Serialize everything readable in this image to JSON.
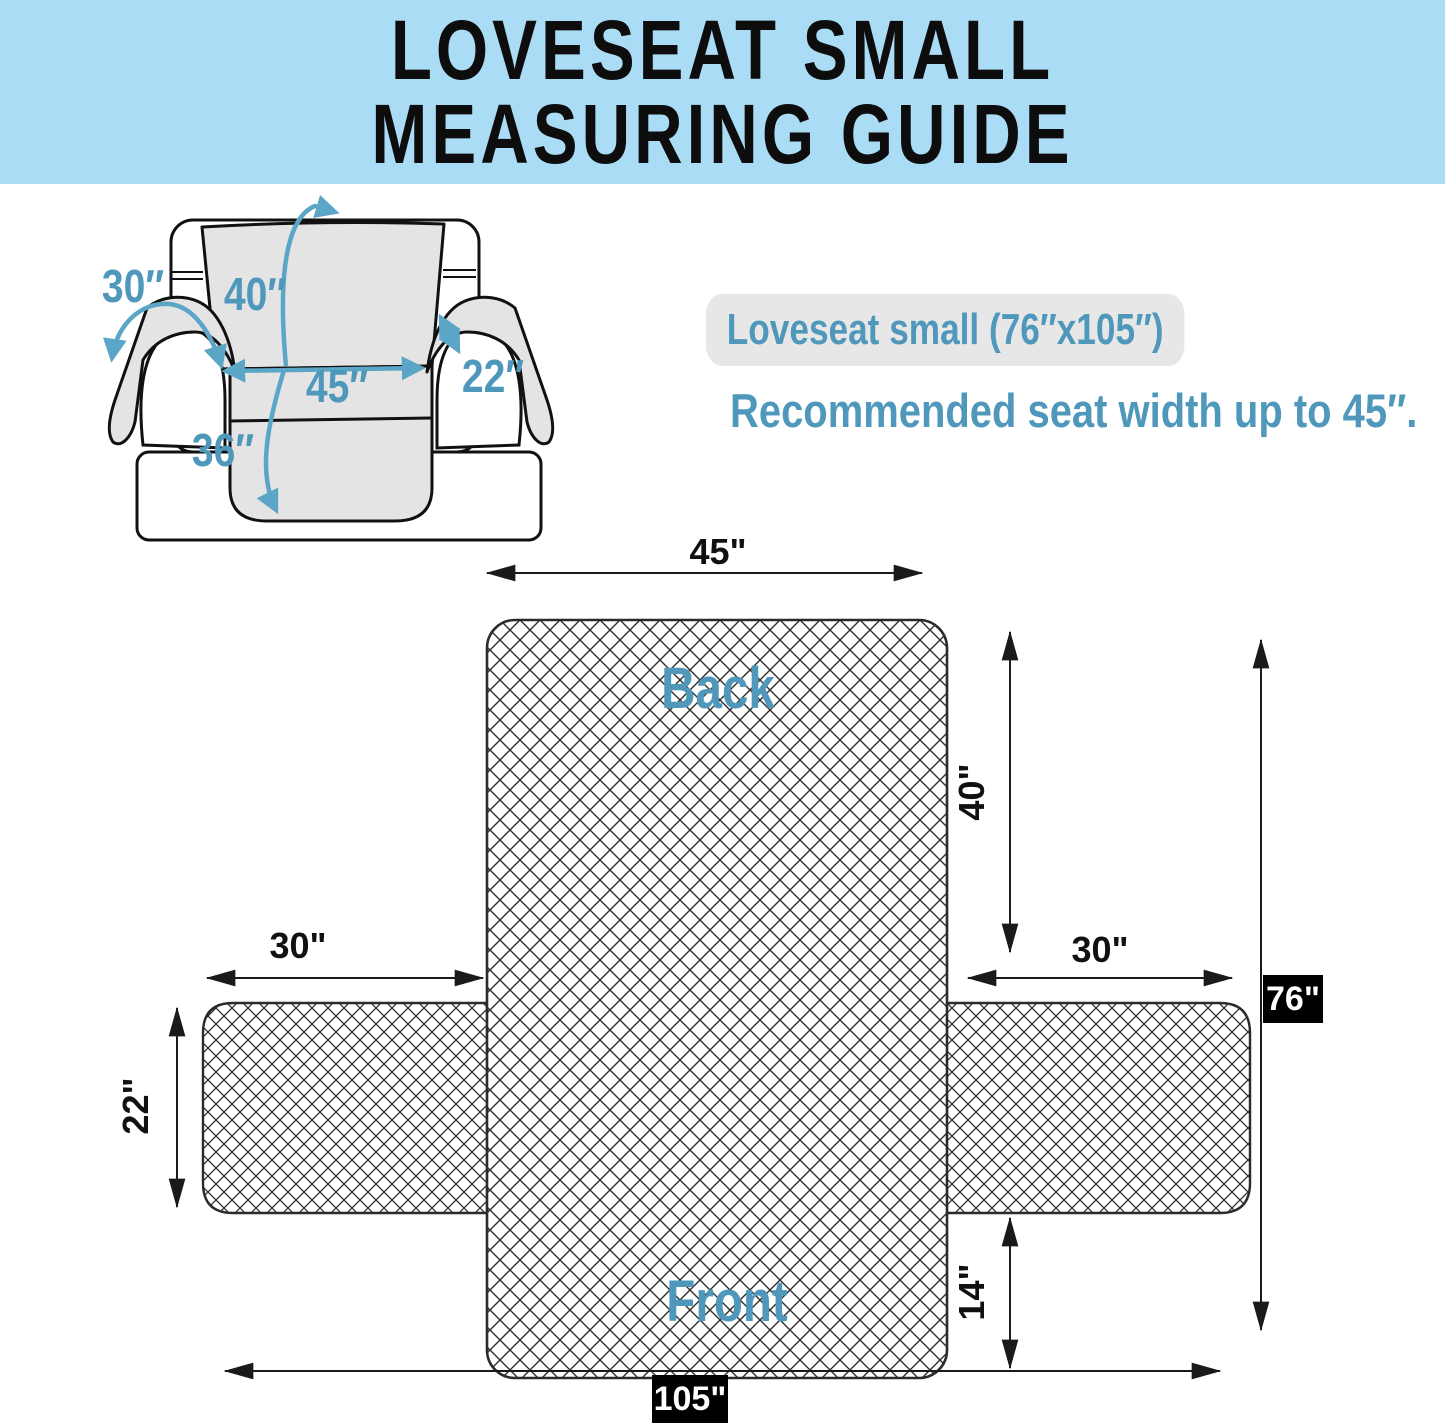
{
  "header": {
    "line1": "LOVESEAT SMALL",
    "line2": "MEASURING GUIDE"
  },
  "product": {
    "size_label": "Loveseat small (76″x105″)",
    "recommendation": "Recommended seat width up to 45″."
  },
  "sofa_illustration": {
    "arm_flap_length": "30″",
    "back_drape_length": "40″",
    "seat_width": "45″",
    "arm_top_width": "22″",
    "seat_drape_length": "36″"
  },
  "flat_pattern": {
    "back_label": "Back",
    "front_label": "Front",
    "top_width": "45\"",
    "back_height": "40\"",
    "left_arm_length": "30\"",
    "right_arm_length": "30\"",
    "arm_width": "22\"",
    "front_skirt_height": "14\"",
    "total_height": "76\"",
    "total_width": "105\""
  },
  "colors": {
    "header_bg": "#abdcf5",
    "accent_blue_text": "#4f98bb",
    "accent_blue_arrow": "#5ba6c6",
    "cover_gray": "#e4e4e4",
    "pill_gray": "#e7e7e7",
    "line_black": "#1a1a1a",
    "badge_bg": "#000000"
  }
}
